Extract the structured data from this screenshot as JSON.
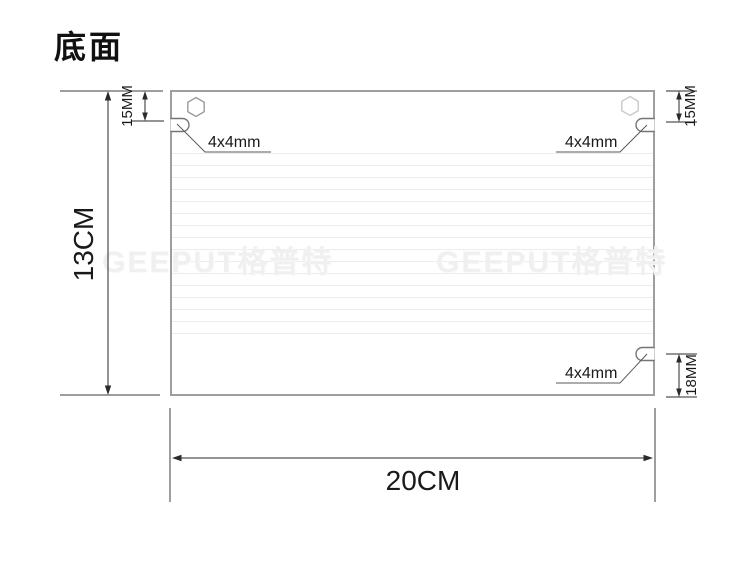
{
  "title": "底面",
  "watermark": {
    "text": "GEEPUT格普特"
  },
  "dimensions": {
    "height_label": "13CM",
    "width_label": "20CM",
    "top_left_offset_label": "15MM",
    "top_right_offset_label": "15MM",
    "bottom_right_offset_label": "18MM"
  },
  "slots": {
    "top_left_label": "4x4mm",
    "top_right_label": "4x4mm",
    "bottom_right_label": "4x4mm"
  },
  "colors": {
    "text": "#111111",
    "panel_border": "#9e9e9e",
    "dimension_line": "#2a2a2a",
    "striation": "#ececec",
    "watermark": "#f0f0f0"
  }
}
